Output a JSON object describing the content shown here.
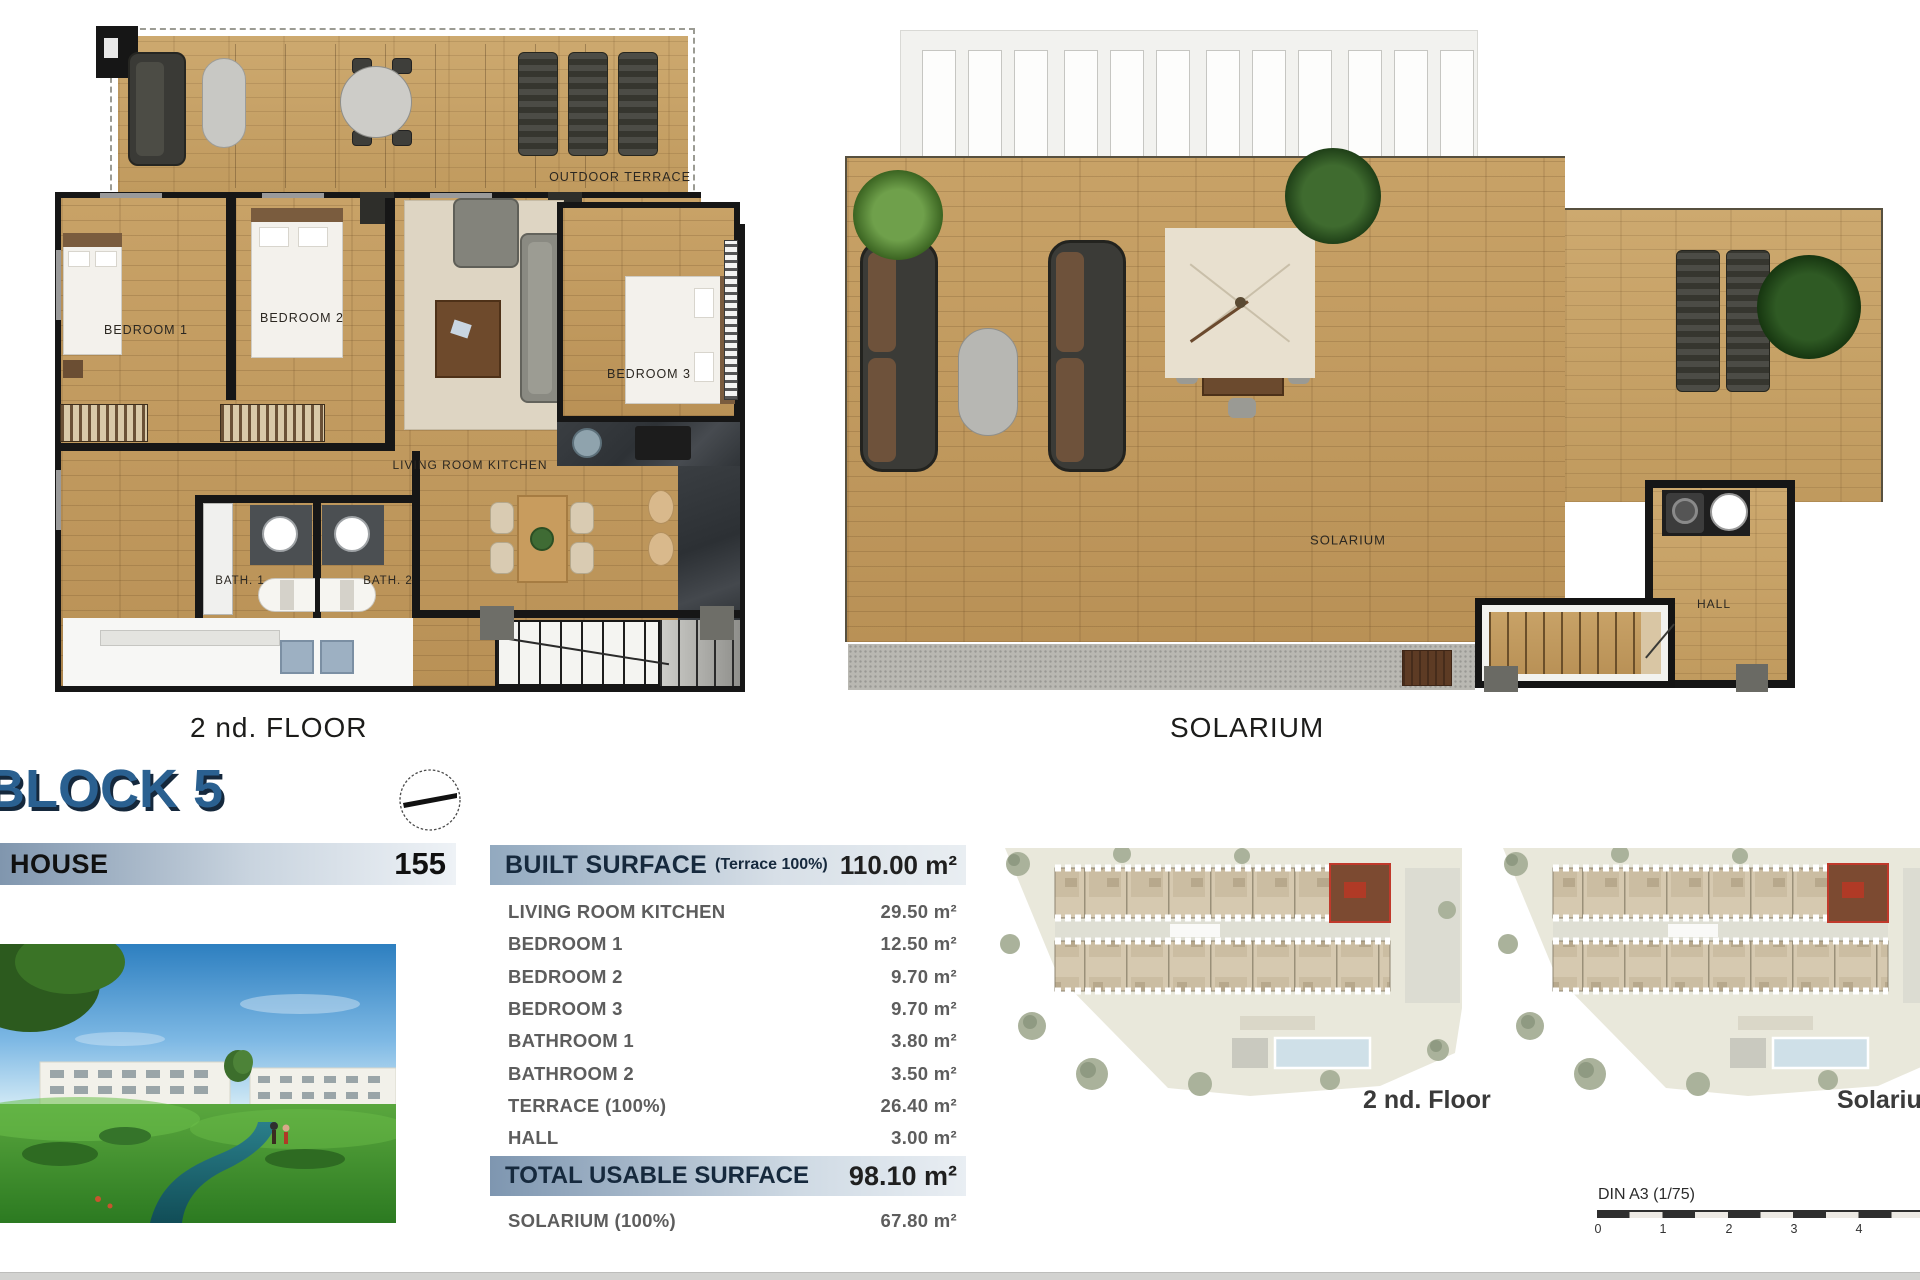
{
  "document": {
    "floor_plans": {
      "left": {
        "caption": "2 nd. FLOOR",
        "rooms": {
          "outdoor_terrace": "OUTDOOR TERRACE",
          "bedroom_1": "BEDROOM 1",
          "bedroom_2": "BEDROOM 2",
          "bedroom_3": "BEDROOM 3",
          "living_room_kitchen": "LIVING ROOM KITCHEN",
          "bath_1": "BATH. 1",
          "bath_2": "BATH. 2"
        }
      },
      "right": {
        "caption": "SOLARIUM",
        "rooms": {
          "solarium": "SOLARIUM",
          "hall": "HALL"
        }
      }
    },
    "block_title": "BLOCK 5",
    "house_row": {
      "label": "HOUSE",
      "number": "155"
    },
    "surface_table": {
      "header": {
        "label": "BUILT SURFACE",
        "note": "(Terrace 100%)",
        "value": "110.00 m²"
      },
      "rows": [
        {
          "label": "LIVING ROOM KITCHEN",
          "value": "29.50 m²"
        },
        {
          "label": "BEDROOM 1",
          "value": "12.50 m²"
        },
        {
          "label": "BEDROOM 2",
          "value": "9.70 m²"
        },
        {
          "label": "BEDROOM 3",
          "value": "9.70 m²"
        },
        {
          "label": "BATHROOM 1",
          "value": "3.80 m²"
        },
        {
          "label": "BATHROOM 2",
          "value": "3.50 m²"
        },
        {
          "label": "TERRACE (100%)",
          "value": "26.40 m²"
        },
        {
          "label": "HALL",
          "value": "3.00 m²"
        }
      ],
      "total": {
        "label": "TOTAL USABLE SURFACE",
        "value": "98.10 m²"
      },
      "solarium_row": {
        "label": "SOLARIUM (100%)",
        "value": "67.80 m²"
      }
    },
    "site_plans": {
      "left_caption": "2 nd. Floor",
      "right_caption": "Solarium"
    },
    "scale_bar": {
      "label": "DIN A3 (1/75)",
      "ticks": [
        "0",
        "1",
        "2",
        "3",
        "4"
      ]
    },
    "colors": {
      "title_blue": "#2a6090",
      "title_shadow": "#15283c",
      "bar_dark": "#8096ae",
      "bar_light": "#eef2f6",
      "wood": "#c19a5f",
      "wall": "#161616",
      "site_ground": "#e9e8db",
      "pool": "#cfe0e8",
      "highlight_red": "#b03a26"
    }
  }
}
